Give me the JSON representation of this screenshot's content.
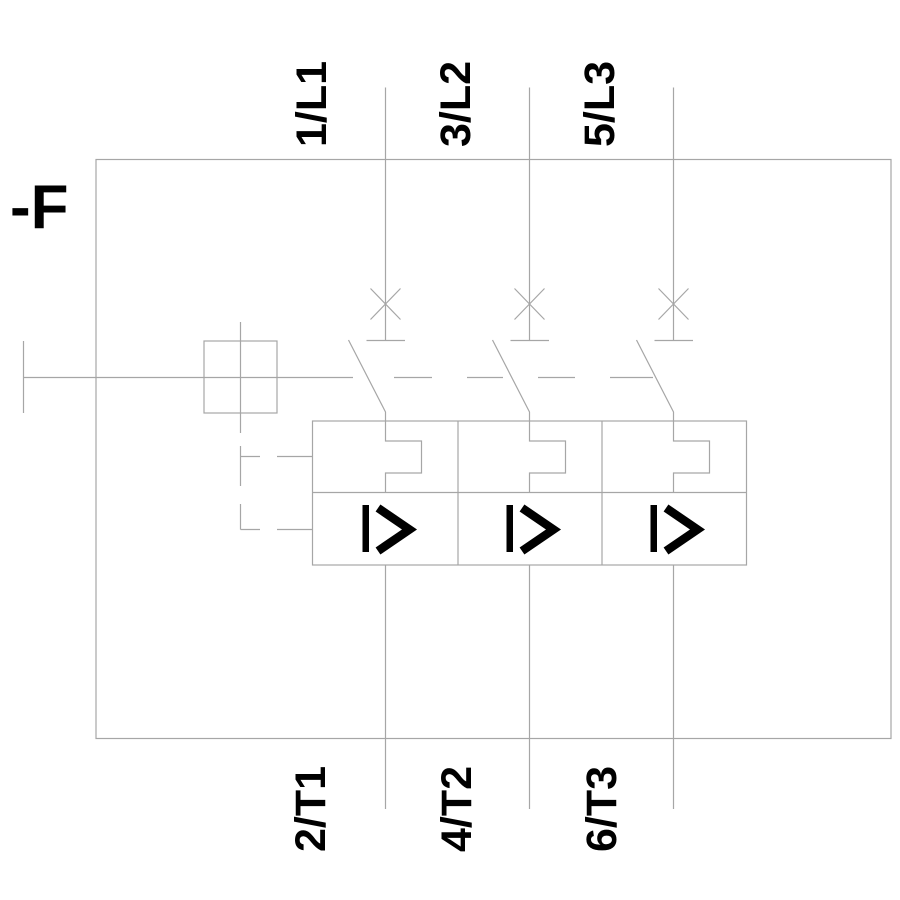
{
  "device": {
    "tag": "-F"
  },
  "terminals": {
    "top": [
      {
        "label": "1/L1"
      },
      {
        "label": "3/L2"
      },
      {
        "label": "5/L3"
      }
    ],
    "bottom": [
      {
        "label": "2/T1"
      },
      {
        "label": "4/T2"
      },
      {
        "label": "6/T3"
      }
    ]
  },
  "trip_block": {
    "poles": "3",
    "overcurrent_symbol": "I>"
  },
  "colors": {
    "line": "#a6a6a6",
    "text": "#000000",
    "background": "#ffffff"
  }
}
